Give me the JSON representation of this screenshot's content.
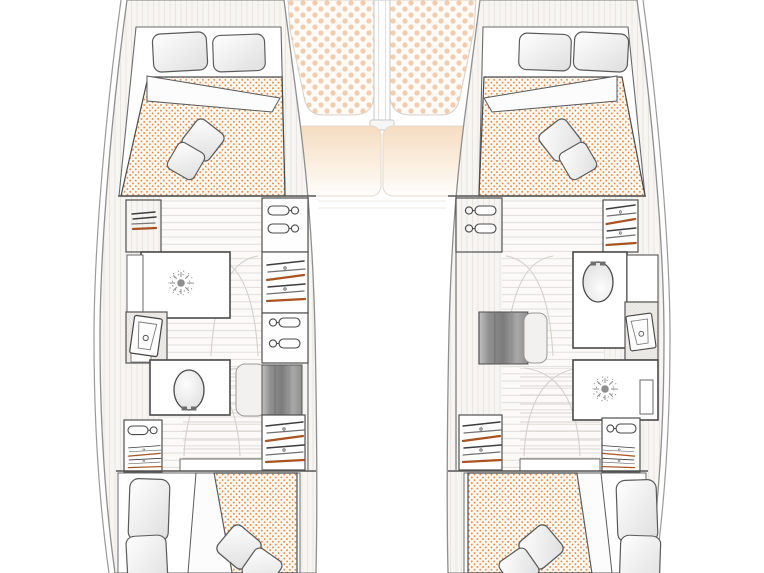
{
  "canvas": {
    "width": 764,
    "height": 573,
    "background": "#ffffff"
  },
  "colors": {
    "hull_outline": "#9a9a9a",
    "wall": "#4a4a4a",
    "furniture_line": "#555555",
    "mattress_base": "#fdf8f0",
    "mattress_dot": "#e0823c",
    "sunpad_base": "#fdfaf7",
    "sunpad_dot": "#f1ccae",
    "window_tint": "#f5dcc1",
    "wood_line": "#e6e3de",
    "floor_plank_line": "#e0ddd8",
    "door_arc": "#d4d1cc",
    "steps_dark": "#7c7c7c",
    "steps_light": "#c2c2c2",
    "accent_rust": "#a85320",
    "shower_symbol": "#8f8f8f",
    "counter_stipple": "#d5d2cc"
  },
  "legend_icons": [
    {
      "name": "toilet-icon",
      "meaning": "marine toilet"
    },
    {
      "name": "washbasin-icon",
      "meaning": "washbasin on counter"
    },
    {
      "name": "shower-drain-icon",
      "meaning": "shower"
    },
    {
      "name": "clothes-hanger-icon",
      "meaning": "hanging locker"
    },
    {
      "name": "wardrobe-hangers-icon",
      "meaning": "wardrobe with hangers"
    },
    {
      "name": "shelf-stack-icon",
      "meaning": "storage shelves"
    },
    {
      "name": "steps-icon",
      "meaning": "companionway steps"
    }
  ],
  "floorplan": {
    "type": "catamaran-interior-layout",
    "view": "top-down",
    "hulls": {
      "port": {
        "forward_cabin": [
          "double-berth",
          "two-pillows",
          "folded-sheet",
          "two-throw-pillows"
        ],
        "midship": [
          "shelf-cabinet",
          "hanging-lockers",
          "wardrobe",
          "shower",
          "washbasin",
          "toilet",
          "companionway-steps"
        ],
        "aft_cabin": [
          "double-berth",
          "two-pillows",
          "folded-sheet",
          "two-throw-pillows"
        ]
      },
      "starboard": {
        "forward_cabin": [
          "double-berth",
          "two-pillows",
          "folded-sheet",
          "two-throw-pillows"
        ],
        "midship": [
          "hanging-lockers",
          "wardrobe",
          "toilet",
          "washbasin",
          "shower",
          "companionway-steps"
        ],
        "aft_cabin": [
          "double-berth",
          "two-pillows",
          "folded-sheet",
          "two-throw-pillows"
        ]
      }
    },
    "foredeck": [
      "port-sunpad",
      "starboard-sunpad",
      "mast-beam",
      "port-forward-window",
      "starboard-forward-window",
      "side-sunpad-strips"
    ]
  }
}
